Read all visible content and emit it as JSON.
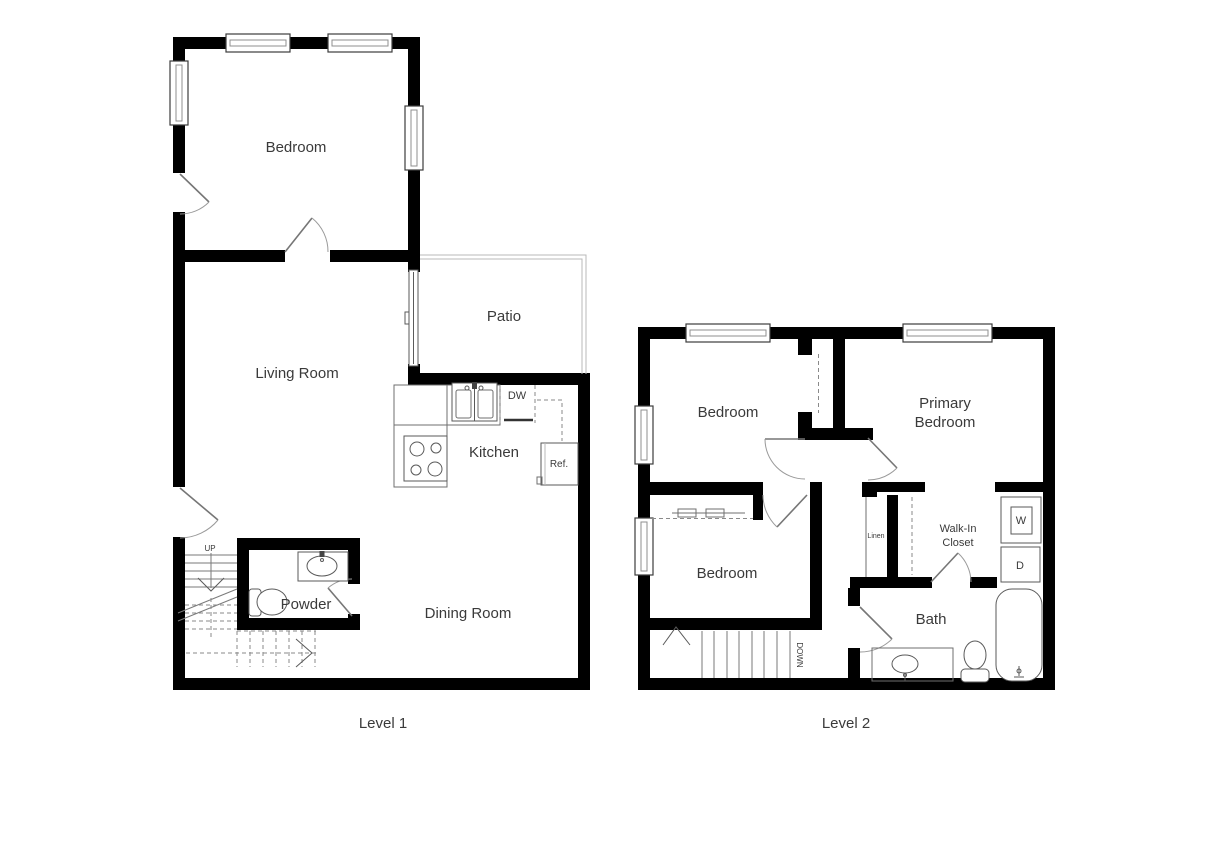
{
  "page": {
    "background": "#ffffff"
  },
  "colors": {
    "wall": "#000000",
    "fixture_line": "#5a5a5a",
    "dashed_line": "#8a8a8a",
    "text": "#3a3a3a"
  },
  "level1": {
    "title": "Level 1",
    "rooms": {
      "bedroom": "Bedroom",
      "living_room": "Living Room",
      "patio": "Patio",
      "kitchen": "Kitchen",
      "powder": "Powder",
      "dining_room": "Dining Room"
    },
    "labels": {
      "dishwasher": "DW",
      "refrigerator": "Ref.",
      "stairs_up": "UP"
    }
  },
  "level2": {
    "title": "Level 2",
    "rooms": {
      "bedroom_top": "Bedroom",
      "primary_line1": "Primary",
      "primary_line2": "Bedroom",
      "bedroom_bottom": "Bedroom",
      "walk_in_line1": "Walk-In",
      "walk_in_line2": "Closet",
      "bath": "Bath",
      "linen": "Linen"
    },
    "labels": {
      "washer": "W",
      "dryer": "D",
      "stairs_down": "DOWN"
    }
  }
}
